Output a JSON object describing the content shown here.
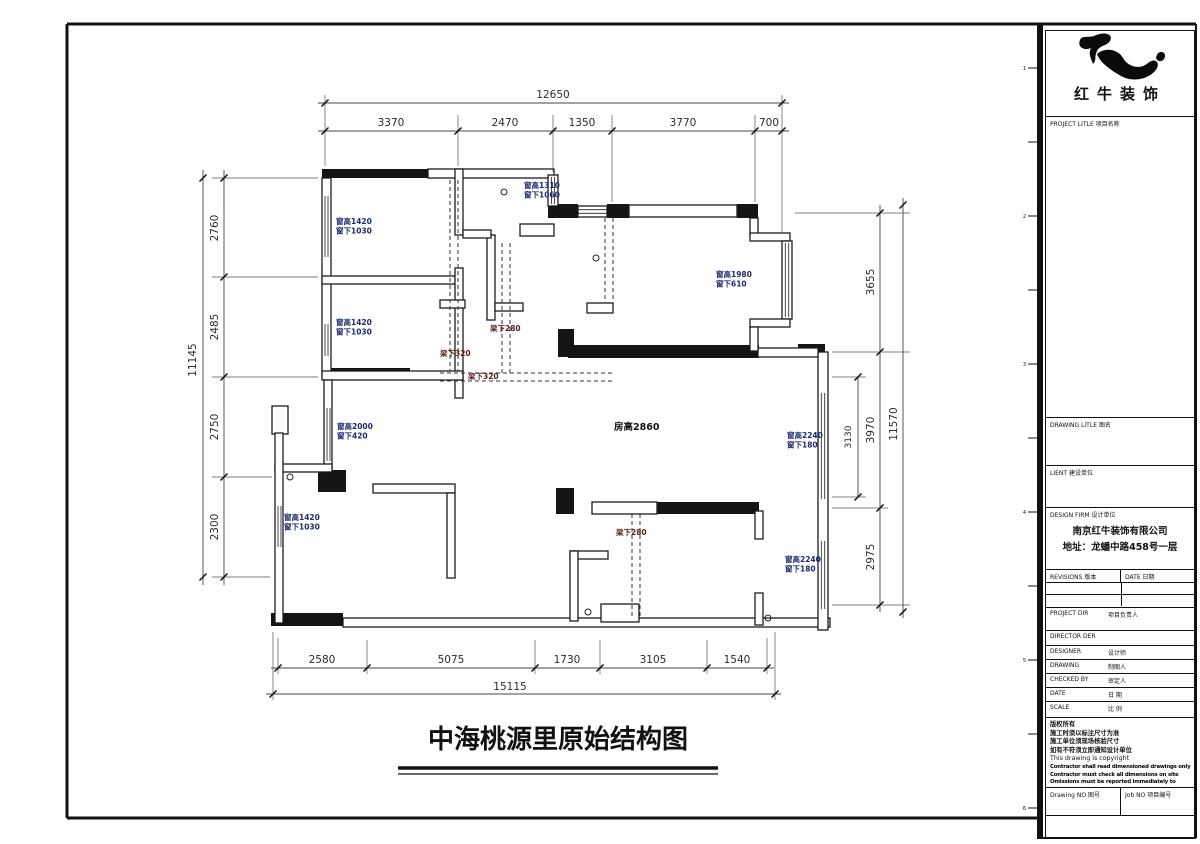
{
  "title": {
    "text": "中海桃源里原始结构图"
  },
  "frame": {
    "tick_numbers": [
      "1",
      "2",
      "3",
      "4",
      "5",
      "6"
    ]
  },
  "plan": {
    "room_height": "房高2860",
    "room_labels": [
      {
        "l1": "窗高1420",
        "l2": "窗下1030"
      },
      {
        "l1": "窗高1420",
        "l2": "窗下1030"
      },
      {
        "l1": "窗高2000",
        "l2": "窗下420"
      },
      {
        "l1": "窗高1420",
        "l2": "窗下1030"
      },
      {
        "l1": "窗高1310",
        "l2": "窗下1060"
      },
      {
        "l1": "窗高1980",
        "l2": "窗下610"
      },
      {
        "l1": "窗高2240",
        "l2": "窗下180"
      },
      {
        "l1": "窗高2240",
        "l2": "窗下180"
      }
    ],
    "beam_labels": [
      "梁下320",
      "梁下320",
      "梁下280",
      "梁下280"
    ]
  },
  "dims": {
    "top": {
      "total": "12650",
      "segs": [
        "3370",
        "2470",
        "1350",
        "3770",
        "700"
      ]
    },
    "left": {
      "total": "11145",
      "segs": [
        "2760",
        "2485",
        "2750",
        "2300"
      ]
    },
    "right": {
      "total": "11570",
      "segs": [
        "3655",
        "3970",
        "2975"
      ],
      "inner": "3130"
    },
    "bottom": {
      "total": "15115",
      "segs": [
        "2580",
        "5075",
        "1730",
        "3105",
        "1540"
      ]
    }
  },
  "titleblock": {
    "brand": "红牛装饰",
    "project_label": "PROJECT LITLE  项目名称",
    "drawing_title_label": "DRAWING LITLE  图名",
    "client_label": "LIENT  建设单位",
    "firm_label": "DESIGN FIRM  设计单位",
    "firm_name": "南京红牛装饰有限公司",
    "firm_address": "地址：龙蟠中路458号一层",
    "revisions_label": "REVISIONS  版本",
    "rev_date_label": "DATE  日期",
    "rows": [
      {
        "en": "PROJECT DIR",
        "zh": "项目负责人"
      },
      {
        "en": "DIRECTOR DER",
        "zh": ""
      },
      {
        "en": "DESIGNER",
        "zh": "设计师"
      },
      {
        "en": "DRAWING",
        "zh": "制图人"
      },
      {
        "en": "CHECKED BY",
        "zh": "审定人"
      },
      {
        "en": "DATE",
        "zh": "日 期"
      },
      {
        "en": "SCALE",
        "zh": "比 例"
      }
    ],
    "notes": [
      "版权所有",
      "施工时须以标注尺寸为准",
      "施工单位须现场核验尺寸",
      "如有不符须立即通知设计单位",
      "This drawing is copyright"
    ],
    "notes_bold": [
      "Contractor shall read dimensioned drawings only",
      "Contractor must check all dimensions on site",
      "Omissions must be reported immediately to architects"
    ],
    "drawing_no_label": "Drawing NO  图号",
    "job_no_label": "Job NO  项目编号"
  }
}
